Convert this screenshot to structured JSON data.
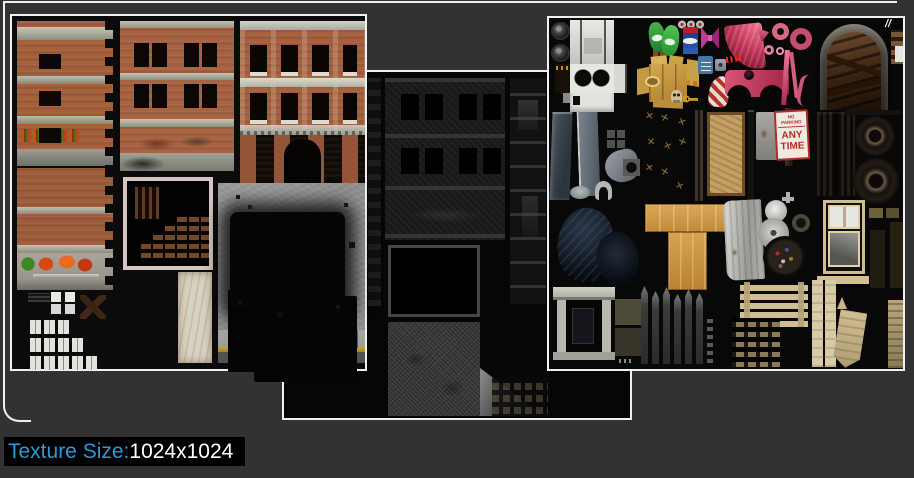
{
  "window": {
    "background": "#323232",
    "border_color": "#F0F0F0"
  },
  "atlases": {
    "diffuse": {
      "label": "building diffuse texture atlas"
    },
    "dark": {
      "label": "building night illumination texture atlas"
    },
    "props": {
      "label": "props texture atlas"
    }
  },
  "props_panel": {
    "no_parking_sign": {
      "header": "NO PARKING",
      "line1": "ANY",
      "line2": "TIME"
    },
    "moth_glyph": "✕",
    "slash_glyph": "//"
  },
  "footer": {
    "label": "Texture Size:",
    "value": "1024x1024",
    "label_color": "#2B9AD6",
    "value_color": "#FFFFFF",
    "background": "#000000"
  }
}
